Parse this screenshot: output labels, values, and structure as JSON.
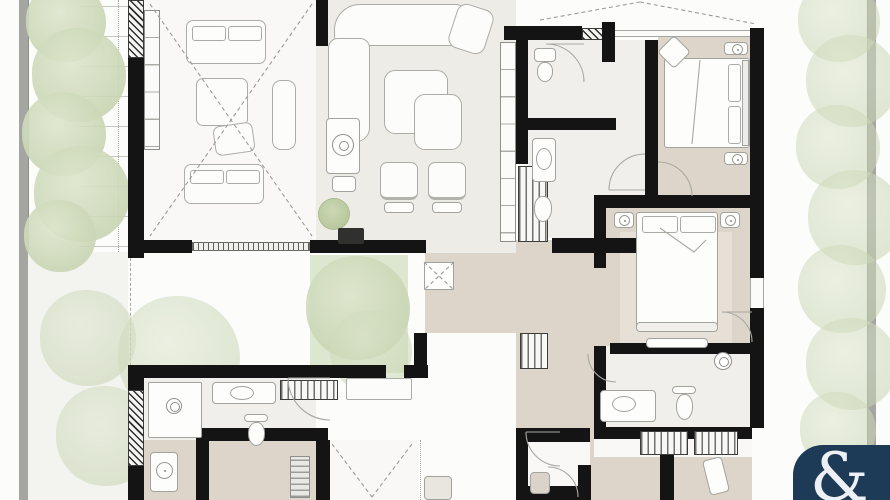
{
  "image_type": "residential-floor-plan",
  "logo": {
    "glyph": "&"
  },
  "palette": {
    "page": "#fcfcfb",
    "wall": "#141414",
    "boundary": "#a5a5a2",
    "floor_beige": "#ddd5c9",
    "floor_white": "#f9f8f6",
    "floor_living": "#eeece6",
    "floor_bath": "#f1efec",
    "terrace": "#f3f3f0",
    "courtyard_green": "#dde6cf",
    "foliage": "#cbd7b6",
    "furniture_line": "#a3a39e",
    "logo_bg": "#1d3a56",
    "logo_fg": "#edf1f5"
  }
}
